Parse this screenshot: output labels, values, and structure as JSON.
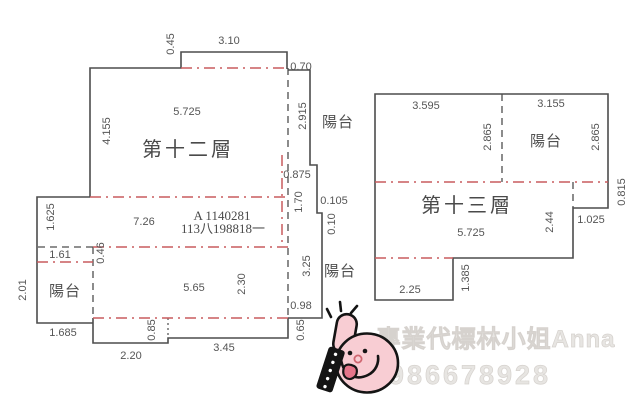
{
  "colors": {
    "outline": "#4d4d4d",
    "boundary_red": "#c95b5e",
    "dimension_text": "#555555",
    "watermark_text": "#e7e5e2",
    "mascot_pink": "#f8cdd3",
    "mascot_outline": "#141414",
    "mascot_tongue": "#e4758a"
  },
  "floor12": {
    "title": "第十二層",
    "balcony_right_top": "陽台",
    "balcony_left": "陽台",
    "balcony_right_bottom": "陽台",
    "stamp_line1": "A 1140281",
    "stamp_line2": "113八198818一",
    "dims": {
      "top_notch_height": "0.45",
      "top_notch_width": "3.10",
      "balcony_top_width": "0.70",
      "upper_room_width": "5.725",
      "upper_room_height": "4.155",
      "balcony_right_height": "2.915",
      "right_step_a": "0.875",
      "right_step_b": "1.70",
      "right_step_c": "0.105",
      "right_step_d": "0.10",
      "mid_band_height": "1.625",
      "mid_band_width": "7.26",
      "left_step_width": "1.61",
      "left_step_height": "0.46",
      "balcony_left_height": "2.01",
      "balcony_left_width": "1.685",
      "lower_room_width": "5.65",
      "lower_room_height": "2.30",
      "balcony_right2_height": "3.25",
      "balcony_right2_width": "0.98",
      "bottom_notch_left_depth": "0.85",
      "bottom_notch_left_width": "2.20",
      "bottom_notch_right_width": "3.45",
      "bottom_notch_right_depth": "0.65"
    }
  },
  "floor13": {
    "title": "第十三層",
    "balcony": "陽台",
    "dims": {
      "top_left_width": "3.595",
      "top_right_width": "3.155",
      "balcony_height_left": "2.865",
      "balcony_height_right": "2.865",
      "right_step_height": "0.815",
      "right_step_width": "1.025",
      "room_width": "5.725",
      "room_height": "2.44",
      "bottom_notch_depth": "1.385",
      "bottom_notch_width": "2.25"
    }
  },
  "watermark": {
    "agent_text": "專業代標林小姐Anna",
    "phone": "0986678928"
  }
}
